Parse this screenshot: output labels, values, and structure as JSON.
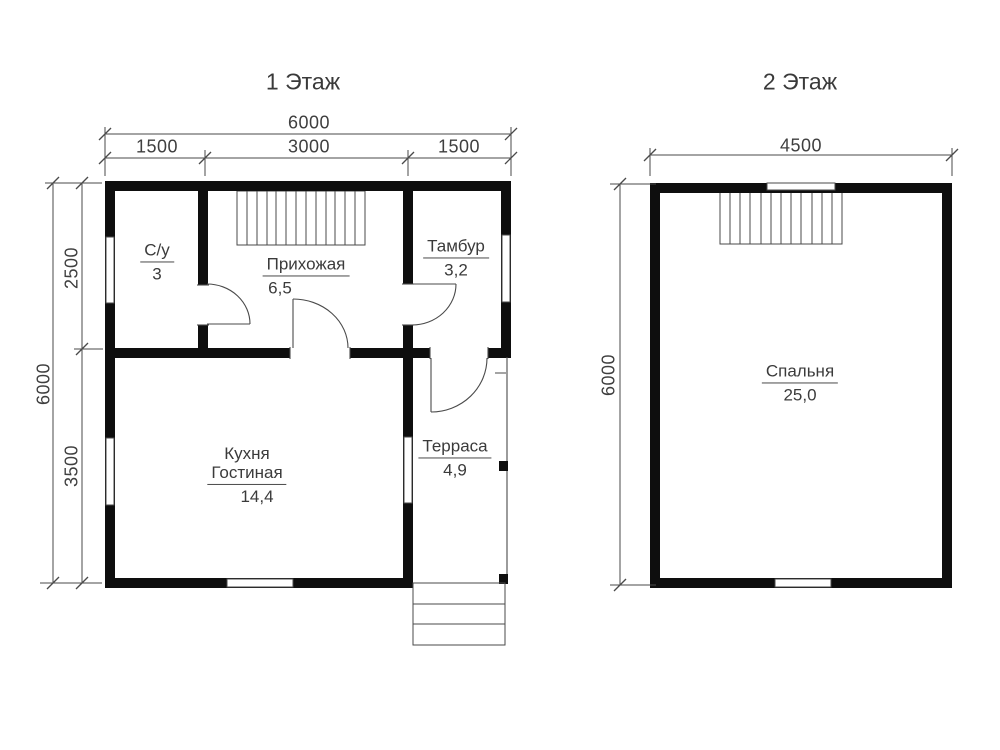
{
  "floor1": {
    "title": "1 Этаж",
    "dim_width_total": "6000",
    "dim_width_segments": [
      "1500",
      "3000",
      "1500"
    ],
    "dim_height_total": "6000",
    "dim_height_segments": [
      "2500",
      "3500"
    ],
    "rooms": {
      "bathroom": {
        "name": "С/у",
        "area": "3"
      },
      "hallway": {
        "name": "Прихожая",
        "area": "6,5"
      },
      "vestibule": {
        "name": "Тамбур",
        "area": "3,2"
      },
      "kitchen": {
        "name_line1": "Кухня",
        "name_line2": "Гостиная",
        "area": "14,4"
      },
      "terrace": {
        "name": "Терраса",
        "area": "4,9"
      }
    }
  },
  "floor2": {
    "title": "2 Этаж",
    "dim_width_total": "4500",
    "dim_height_total": "6000",
    "rooms": {
      "bedroom": {
        "name": "Спальня",
        "area": "25,0"
      }
    }
  },
  "colors": {
    "wall": "#0e0e0e",
    "line": "#4a4a4a",
    "text": "#3d3d3d",
    "background": "#ffffff"
  }
}
